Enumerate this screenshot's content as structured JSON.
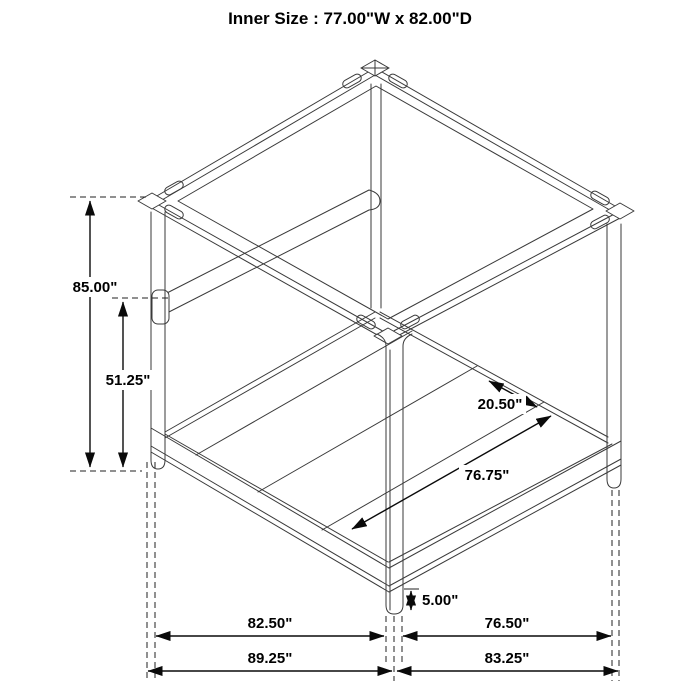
{
  "title": "Inner Size : 77.00\"W x 82.00\"D",
  "dims": [
    {
      "id": "overall-height",
      "value": "85.00\""
    },
    {
      "id": "rail-top-height",
      "value": "51.25\""
    },
    {
      "id": "corner-clearance",
      "value": "20.50\""
    },
    {
      "id": "inner-rail-length",
      "value": "76.75\""
    },
    {
      "id": "leg-height",
      "value": "5.00\""
    },
    {
      "id": "front-width-inner",
      "value": "82.50\""
    },
    {
      "id": "side-depth-inner",
      "value": "76.50\""
    },
    {
      "id": "front-width-overall",
      "value": "89.25\""
    },
    {
      "id": "side-depth-overall",
      "value": "83.25\""
    }
  ],
  "colors": {
    "line": "#3a3a3a",
    "dimension": "#0a0a0a",
    "background": "#ffffff"
  }
}
